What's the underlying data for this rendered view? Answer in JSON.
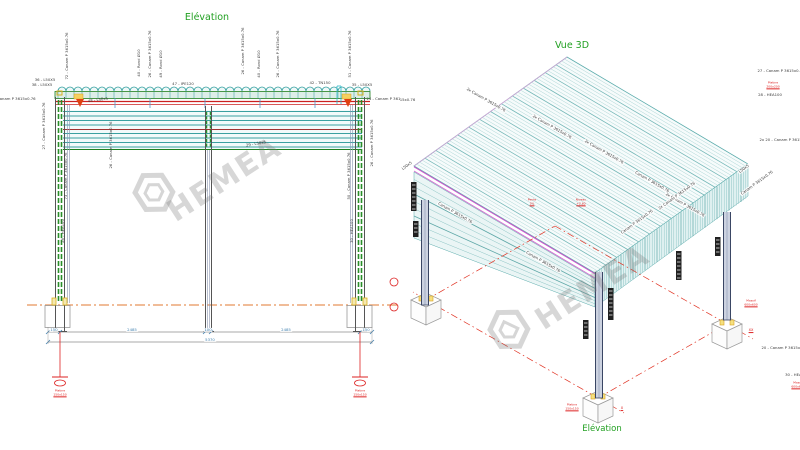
{
  "watermark": {
    "brand": "HEMEA"
  },
  "elevation": {
    "title": "Elévation",
    "labels": [
      {
        "text": "36 - L50X5",
        "x": 45,
        "y": 80,
        "rot": 0
      },
      {
        "text": "38 - L50X5",
        "x": 42,
        "y": 85,
        "rot": 0
      },
      {
        "text": "72 - Canam P 3615x0.76",
        "x": 67,
        "y": 56,
        "rot": -90
      },
      {
        "text": "40 - Rond Ø10",
        "x": 139,
        "y": 63,
        "rot": -90
      },
      {
        "text": "26 - Canam P 3615x0.76",
        "x": 150,
        "y": 54,
        "rot": -90
      },
      {
        "text": "49 - Rond Ø10",
        "x": 161,
        "y": 64,
        "rot": -90
      },
      {
        "text": "47 - IPE120",
        "x": 183,
        "y": 84,
        "rot": 0
      },
      {
        "text": "26 - Canam P 3615x0.76",
        "x": 243,
        "y": 51,
        "rot": -90
      },
      {
        "text": "40 - Rond Ø10",
        "x": 259,
        "y": 64,
        "rot": -90
      },
      {
        "text": "26 - Canam P 3615x0.76",
        "x": 278,
        "y": 54,
        "rot": -90
      },
      {
        "text": "42 - TN150",
        "x": 320,
        "y": 83,
        "rot": 0
      },
      {
        "text": "51 - Canam P 3615x0.76",
        "x": 350,
        "y": 54,
        "rot": -90
      },
      {
        "text": "35 - L50X5",
        "x": 362,
        "y": 85,
        "rot": 0
      },
      {
        "text": "04 - Canam P 3615x0.76",
        "x": 12,
        "y": 99,
        "rot": 0
      },
      {
        "text": "24 - Canam P 3615x0.76",
        "x": 390,
        "y": 99,
        "rot": 0
      },
      {
        "text": "48 - L50x5",
        "x": 98,
        "y": 100,
        "rot": -8
      },
      {
        "text": "27 - Canam P 3615x0.76",
        "x": 44,
        "y": 126,
        "rot": -90
      },
      {
        "text": "73 - Canam P 3615x0.76",
        "x": 66,
        "y": 176,
        "rot": -90
      },
      {
        "text": "26 - Canam P 3615x0.76",
        "x": 111,
        "y": 145,
        "rot": -90
      },
      {
        "text": "29 - L50x5",
        "x": 256,
        "y": 144,
        "rot": -10
      },
      {
        "text": "50 - Canam P 3615x0.76",
        "x": 349,
        "y": 176,
        "rot": -90
      },
      {
        "text": "26 - Canam P 3615x0.76",
        "x": 372,
        "y": 143,
        "rot": -90
      },
      {
        "text": "28 - HEA100",
        "x": 63,
        "y": 231,
        "rot": -90
      },
      {
        "text": "30 - HEA100",
        "x": 352,
        "y": 231,
        "rot": -90
      },
      {
        "text": "150",
        "x": 54,
        "y": 330,
        "rot": 0,
        "color": "#4080b0",
        "bg": true
      },
      {
        "text": "2485",
        "x": 132,
        "y": 330,
        "rot": 0,
        "color": "#4080b0",
        "bg": true
      },
      {
        "text": "100",
        "x": 208,
        "y": 330,
        "rot": 0,
        "color": "#4080b0",
        "bg": true
      },
      {
        "text": "2485",
        "x": 286,
        "y": 330,
        "rot": 0,
        "color": "#4080b0",
        "bg": true
      },
      {
        "text": "150",
        "x": 366,
        "y": 330,
        "rot": 0,
        "color": "#4080b0",
        "bg": true
      },
      {
        "text": "5370",
        "x": 210,
        "y": 340,
        "rot": 0,
        "color": "#4080b0",
        "bg": true
      },
      {
        "text": "Platine",
        "x": 60,
        "y": 391,
        "color": "#dd2222",
        "size": 3
      },
      {
        "text": "150x150",
        "x": 60,
        "y": 395,
        "color": "#dd2222",
        "size": 3,
        "u": true
      },
      {
        "text": "Platine",
        "x": 360,
        "y": 391,
        "color": "#dd2222",
        "size": 3
      },
      {
        "text": "150x150",
        "x": 360,
        "y": 395,
        "color": "#dd2222",
        "size": 3,
        "u": true
      }
    ]
  },
  "vue3d": {
    "title": "Vue 3D",
    "footer": "Elévation",
    "labels": [
      {
        "text": "2x Canam P 3615x0.76",
        "x": 86,
        "y": 100,
        "rot": 30,
        "bg": true
      },
      {
        "text": "2x Canam P 3615x0.76",
        "x": 152,
        "y": 127,
        "rot": 30,
        "bg": true
      },
      {
        "text": "2x Canam P 3615x0.76",
        "x": 204,
        "y": 152,
        "rot": 30,
        "bg": true
      },
      {
        "text": "Canam P 3615x0.76",
        "x": 252,
        "y": 182,
        "rot": 30,
        "bg": true
      },
      {
        "text": "2x Canam P 3615x0.76",
        "x": 285,
        "y": 205,
        "rot": 30,
        "bg": true
      },
      {
        "text": "Canam P 3615x0.76",
        "x": 55,
        "y": 213,
        "rot": 30,
        "bg": true
      },
      {
        "text": "Canam P 3615x0.76",
        "x": 143,
        "y": 262,
        "rot": 30,
        "bg": true
      },
      {
        "text": "Canam P 3615x0.76",
        "x": 237,
        "y": 222,
        "rot": -36,
        "bg": true
      },
      {
        "text": "2x Canam P 3615x0.76",
        "x": 277,
        "y": 196,
        "rot": -36,
        "bg": true
      },
      {
        "text": "L50x5",
        "x": 7,
        "y": 166,
        "rot": -36,
        "bg": true
      },
      {
        "text": "L50x5",
        "x": 344,
        "y": 169,
        "rot": -36,
        "bg": true
      },
      {
        "text": "Canam P 3615x0.76",
        "x": 357,
        "y": 183,
        "rot": -36,
        "bg": true
      },
      {
        "text": "Canam P 3615x0.76",
        "x": -4,
        "y": 100,
        "rot": 0
      },
      {
        "text": "27 - Canam P 3615x0.76",
        "x": 381,
        "y": 71,
        "rot": 0
      },
      {
        "text": "Platine",
        "x": 373,
        "y": 83,
        "color": "#dd2222",
        "size": 3
      },
      {
        "text": "200x200",
        "x": 373,
        "y": 87,
        "color": "#dd2222",
        "size": 3,
        "u": true
      },
      {
        "text": "28 - HEA100",
        "x": 370,
        "y": 95,
        "rot": 0
      },
      {
        "text": "2x 20 - Canam P 3615x0.76",
        "x": 386,
        "y": 140,
        "rot": 0
      },
      {
        "text": "Pente",
        "x": 132,
        "y": 200,
        "color": "#dd2222",
        "size": 3
      },
      {
        "text": "3%",
        "x": 132,
        "y": 204,
        "color": "#dd2222",
        "size": 3,
        "u": true
      },
      {
        "text": "Niveau",
        "x": 181,
        "y": 200,
        "color": "#dd2222",
        "size": 3
      },
      {
        "text": "+2.60",
        "x": 181,
        "y": 204,
        "color": "#dd2222",
        "size": 3,
        "u": true
      },
      {
        "text": "Massif",
        "x": 351,
        "y": 301,
        "color": "#dd2222",
        "size": 3
      },
      {
        "text": "600x600",
        "x": 351,
        "y": 305,
        "color": "#dd2222",
        "size": 3,
        "u": true
      },
      {
        "text": "XX",
        "x": 351,
        "y": 331,
        "color": "#dd2222",
        "size": 3.5,
        "u": true
      },
      {
        "text": "20 - Canam P 3615x0.76",
        "x": 385,
        "y": 348,
        "rot": 0
      },
      {
        "text": "30 - HEA100",
        "x": 397,
        "y": 375,
        "rot": 0
      },
      {
        "text": "Massif",
        "x": 398,
        "y": 383,
        "color": "#dd2222",
        "size": 3
      },
      {
        "text": "600x600",
        "x": 398,
        "y": 387,
        "color": "#dd2222",
        "size": 3,
        "u": true
      },
      {
        "text": "Platine",
        "x": 172,
        "y": 405,
        "color": "#dd2222",
        "size": 3
      },
      {
        "text": "150x150",
        "x": 172,
        "y": 409,
        "color": "#dd2222",
        "size": 3,
        "u": true
      },
      {
        "text": "X",
        "x": 222,
        "y": 409,
        "color": "#dd2222",
        "size": 3.5,
        "u": true
      }
    ]
  }
}
